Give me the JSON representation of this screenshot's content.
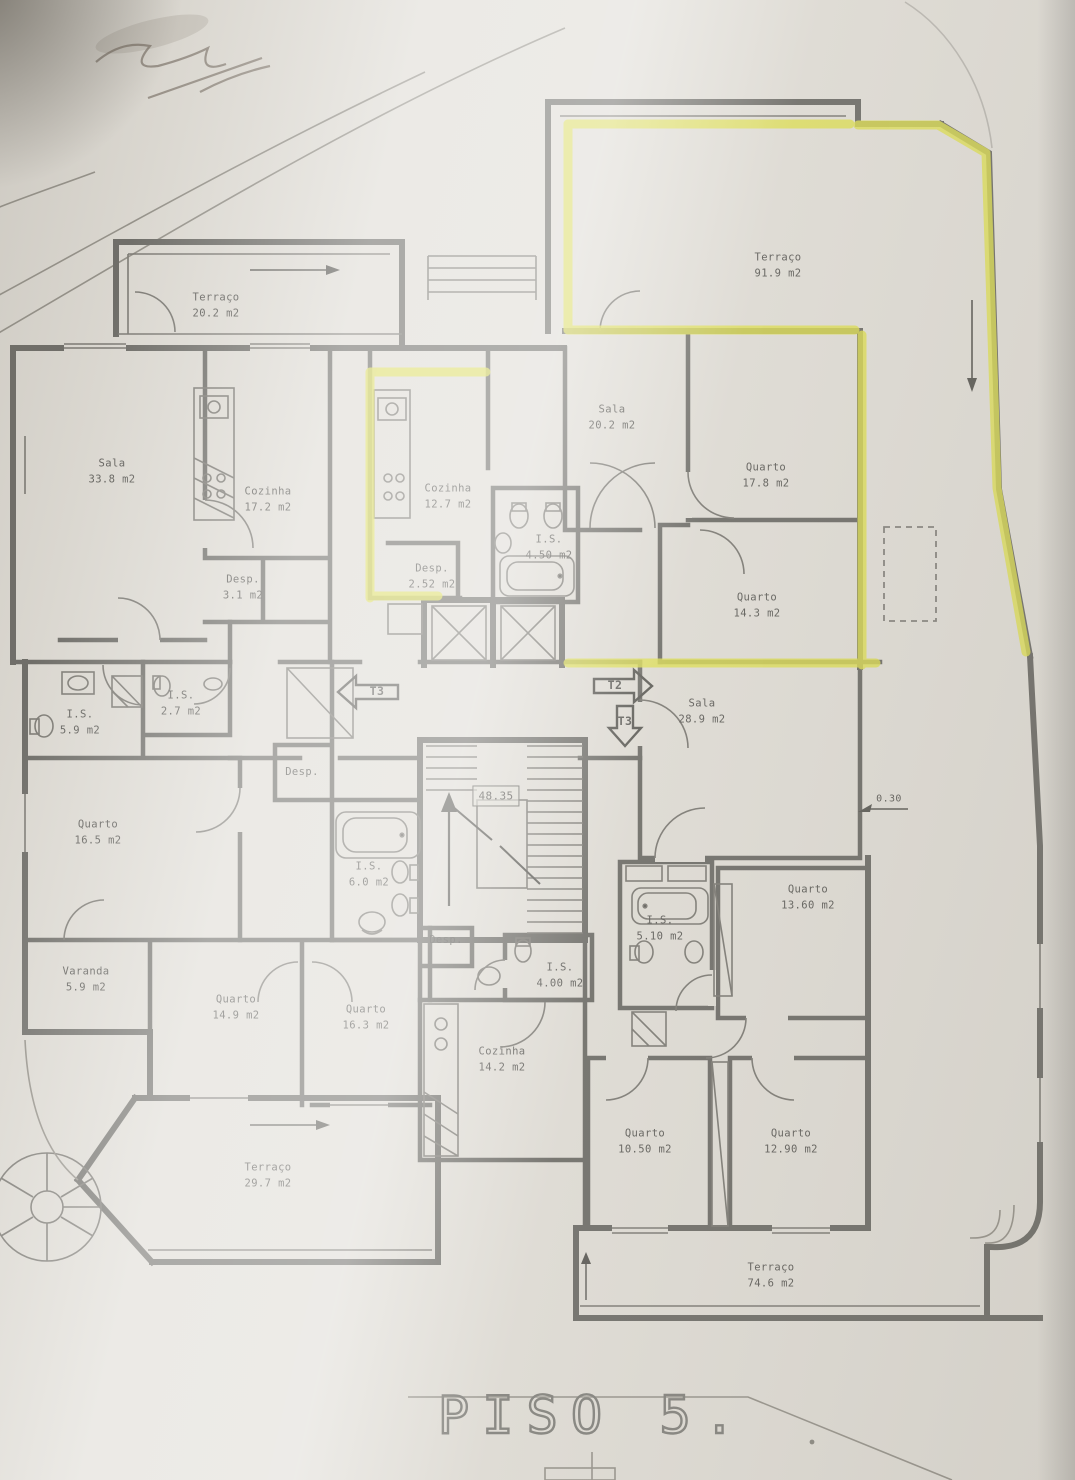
{
  "title": {
    "text": "PISO 5."
  },
  "colors": {
    "wall": "#6f6e69",
    "highlight": "#dcdd52",
    "paper": "#dedbd4",
    "text": "#5f5e5a"
  },
  "plan": {
    "labels": [
      {
        "name": "room-terraco-202",
        "text": "Terraço\n20.2 m2",
        "x": 216,
        "y": 306
      },
      {
        "name": "room-terraco-919",
        "text": "Terraço\n91.9 m2",
        "x": 778,
        "y": 266
      },
      {
        "name": "room-sala-338",
        "text": "Sala\n33.8 m2",
        "x": 112,
        "y": 472
      },
      {
        "name": "room-cozinha-172",
        "text": "Cozinha\n17.2 m2",
        "x": 268,
        "y": 500
      },
      {
        "name": "room-desp-31",
        "text": "Desp.\n3.1 m2",
        "x": 243,
        "y": 588
      },
      {
        "name": "room-cozinha-127",
        "text": "Cozinha\n12.7 m2",
        "x": 448,
        "y": 497
      },
      {
        "name": "room-desp-252",
        "text": "Desp.\n2.52 m2",
        "x": 432,
        "y": 577
      },
      {
        "name": "room-is-450",
        "text": "I.S.\n4.50 m2",
        "x": 549,
        "y": 548
      },
      {
        "name": "room-sala-202",
        "text": "Sala\n20.2 m2",
        "x": 612,
        "y": 418
      },
      {
        "name": "room-quarto-178",
        "text": "Quarto\n17.8 m2",
        "x": 766,
        "y": 476
      },
      {
        "name": "room-quarto-143",
        "text": "Quarto\n14.3 m2",
        "x": 757,
        "y": 606
      },
      {
        "name": "room-sala-289",
        "text": "Sala\n28.9 m2",
        "x": 702,
        "y": 712
      },
      {
        "name": "room-is-59",
        "text": "I.S.\n5.9 m2",
        "x": 80,
        "y": 723
      },
      {
        "name": "room-is-27",
        "text": "I.S.\n2.7 m2",
        "x": 181,
        "y": 704
      },
      {
        "name": "room-quarto-165",
        "text": "Quarto\n16.5 m2",
        "x": 98,
        "y": 833
      },
      {
        "name": "room-varanda-59",
        "text": "Varanda\n5.9 m2",
        "x": 86,
        "y": 980
      },
      {
        "name": "room-desp-mid",
        "text": "Desp.",
        "x": 302,
        "y": 772
      },
      {
        "name": "room-is-60",
        "text": "I.S.\n6.0 m2",
        "x": 369,
        "y": 875
      },
      {
        "name": "room-quarto-149",
        "text": "Quarto\n14.9 m2",
        "x": 236,
        "y": 1008
      },
      {
        "name": "room-quarto-163",
        "text": "Quarto\n16.3 m2",
        "x": 366,
        "y": 1018
      },
      {
        "name": "room-desp-small",
        "text": "Desp.",
        "x": 446,
        "y": 940
      },
      {
        "name": "room-cozinha-142",
        "text": "Cozinha\n14.2 m2",
        "x": 502,
        "y": 1060
      },
      {
        "name": "room-is-400",
        "text": "I.S.\n4.00 m2",
        "x": 560,
        "y": 976
      },
      {
        "name": "room-terraco-297",
        "text": "Terraço\n29.7 m2",
        "x": 268,
        "y": 1176
      },
      {
        "name": "room-is-510",
        "text": "I.S.\n5.10 m2",
        "x": 660,
        "y": 929
      },
      {
        "name": "room-quarto-1360",
        "text": "Quarto\n13.60 m2",
        "x": 808,
        "y": 898
      },
      {
        "name": "room-quarto-1050",
        "text": "Quarto\n10.50 m2",
        "x": 645,
        "y": 1142
      },
      {
        "name": "room-quarto-1290",
        "text": "Quarto\n12.90 m2",
        "x": 791,
        "y": 1142
      },
      {
        "name": "room-terraco-746",
        "text": "Terraço\n74.6 m2",
        "x": 771,
        "y": 1276
      },
      {
        "name": "apartment-type-t3-left",
        "text": "T3",
        "x": 377,
        "y": 692,
        "cls": "tag"
      },
      {
        "name": "apartment-type-t2-right",
        "text": "T2",
        "x": 615,
        "y": 686,
        "cls": "tag"
      },
      {
        "name": "apartment-type-t3-down",
        "text": "T3",
        "x": 625,
        "y": 722,
        "cls": "tag"
      },
      {
        "name": "stair-level-dim",
        "text": "48.35",
        "x": 496,
        "y": 796,
        "cls": "dimbox"
      },
      {
        "name": "wall-dim-030",
        "text": "0.30",
        "x": 889,
        "y": 799,
        "cls": "dim"
      }
    ]
  }
}
